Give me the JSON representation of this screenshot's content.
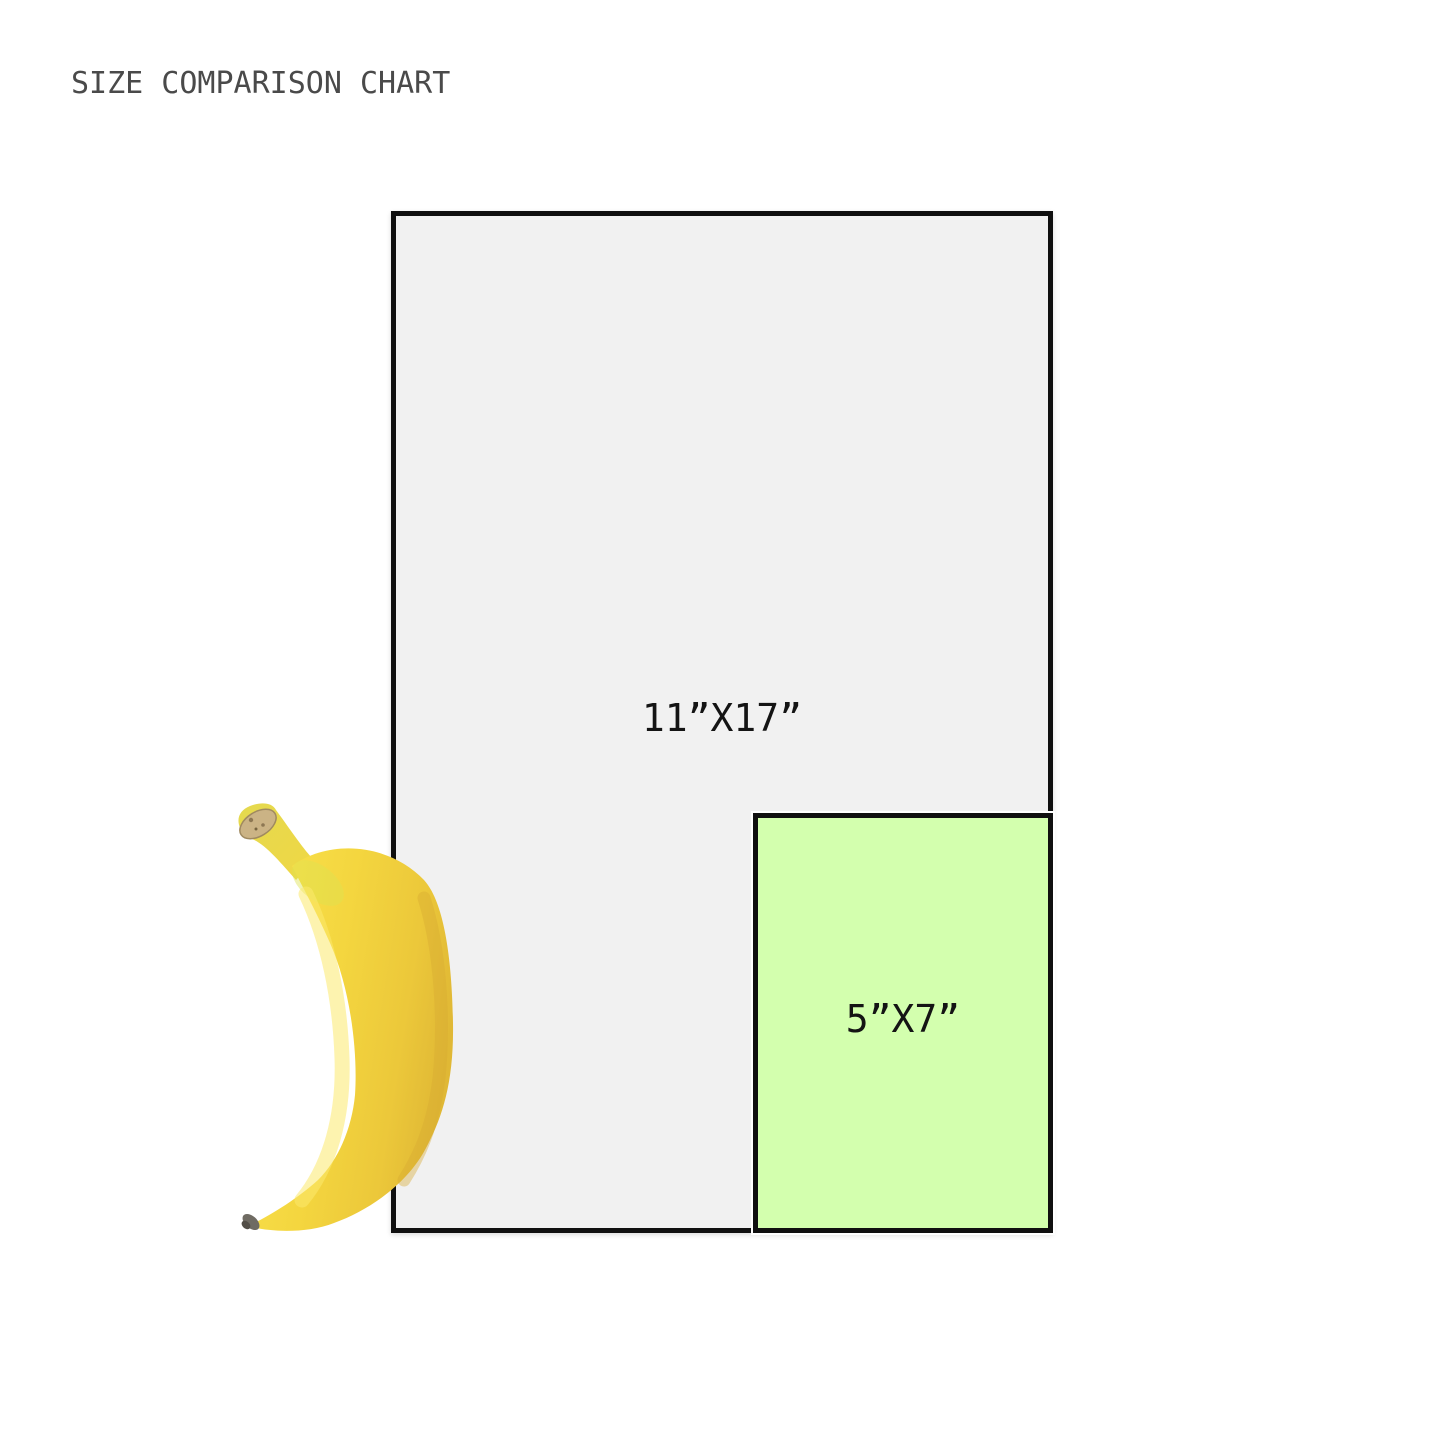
{
  "title": "SIZE COMPARISON CHART",
  "comparison": {
    "reference_object": "banana",
    "sizes": [
      {
        "label": "11”X17”",
        "width_in": 11,
        "height_in": 17,
        "fill": "#f1f1f1"
      },
      {
        "label": "5”X7”",
        "width_in": 5,
        "height_in": 7,
        "fill": "#d3ffae"
      }
    ]
  },
  "colors": {
    "background": "#ffffff",
    "title_text": "#4a4a4a",
    "label_text": "#141414",
    "rect_border": "#101010",
    "large_rect_fill": "#f1f1f1",
    "small_rect_fill": "#d3ffae",
    "small_rect_halo": "#ffffff",
    "banana_yellow": "#f3d73f"
  },
  "icons": {
    "banana": "banana-icon"
  }
}
